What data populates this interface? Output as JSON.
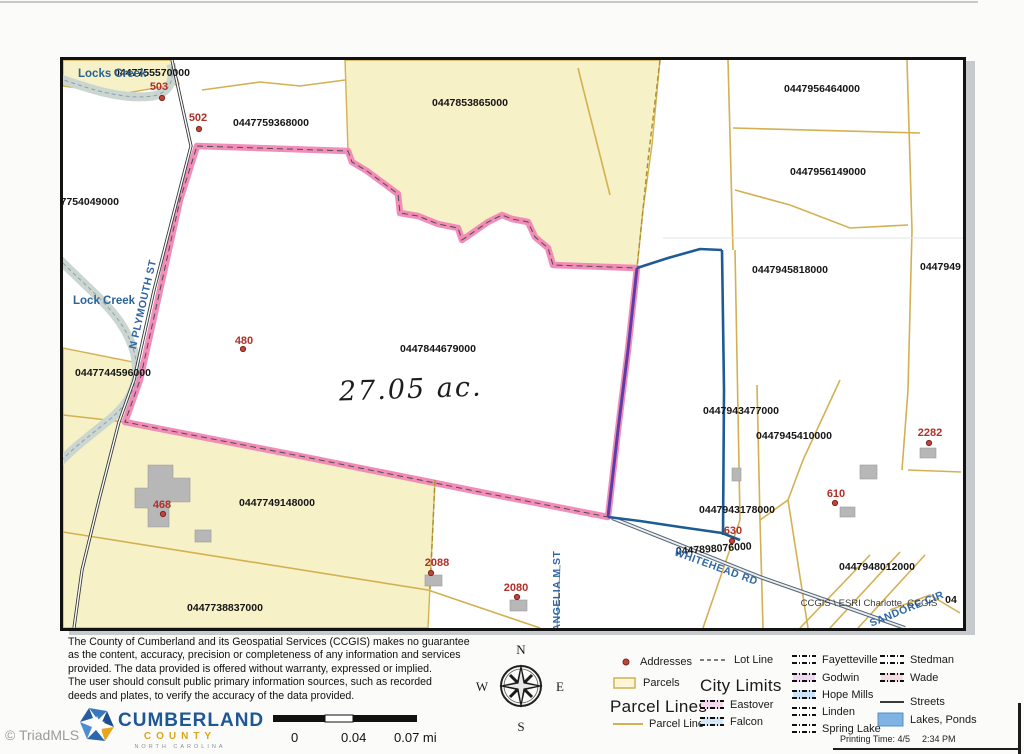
{
  "page": {
    "watermark": "© TriadMLS"
  },
  "print_footer": {
    "printing_time": "Printing Time: 4/5",
    "clock": "2:34 PM"
  },
  "disclaimer": {
    "lines": [
      "The County of Cumberland and its Geospatial Services (CCGIS) makes no guarantee",
      "as the content, accuracy, precision or completeness of any information and services",
      "provided. The data provided is offered without warranty, expressed or implied.",
      "The user should consult public primary information  sources, such as recorded",
      "deeds and plates, to verify the accuracy of the data provided."
    ]
  },
  "logo": {
    "name": "CUMBERLAND",
    "sub": "COUNTY",
    "state": "NORTH CAROLINA"
  },
  "scalebar": {
    "start": "0",
    "mid": "0.04",
    "end": "0.07 mi"
  },
  "compass": {
    "n": "N",
    "e": "E",
    "s": "S",
    "w": "W"
  },
  "legend": {
    "addresses_label": "Addresses",
    "parcels_label": "Parcels",
    "parcel_lines_header": "Parcel Lines",
    "parcel_line_label": "Parcel Line",
    "lot_line_label": "Lot Line",
    "city_limits_header": "City Limits",
    "streets_label": "Streets",
    "lakes_label": "Lakes, Ponds",
    "cities": [
      {
        "name": "Eastover",
        "tint": "#f3d9ea"
      },
      {
        "name": "Falcon",
        "tint": "#d6e8f7"
      },
      {
        "name": "Fayetteville",
        "tint": "#ffffff"
      },
      {
        "name": "Godwin",
        "tint": "#eed9ee"
      },
      {
        "name": "Hope Mills",
        "tint": "#cfe3f6"
      },
      {
        "name": "Linden",
        "tint": "#ffffff"
      },
      {
        "name": "Spring Lake",
        "tint": "#ffffff"
      },
      {
        "name": "Stedman",
        "tint": "#ffffff"
      },
      {
        "name": "Wade",
        "tint": "#f3dde3"
      }
    ]
  },
  "map": {
    "area_note": "27.05 ac.",
    "credit": "CCGIS \\ ESRI Charlotte, CCGIS",
    "edge_label": "04",
    "parcels": [
      {
        "id": "0447755570000"
      },
      {
        "id": "0447759368000"
      },
      {
        "id": "0447853865000"
      },
      {
        "id": "0447956464000"
      },
      {
        "id": "0447956149000"
      },
      {
        "id": "0447754049000"
      },
      {
        "id": "0447744596000"
      },
      {
        "id": "0447844679000"
      },
      {
        "id": "0447945818000"
      },
      {
        "id": "0447949"
      },
      {
        "id": "0447943477000"
      },
      {
        "id": "0447945410000"
      },
      {
        "id": "0447943178000"
      },
      {
        "id": "0447898076000"
      },
      {
        "id": "0447948012000"
      },
      {
        "id": "0447749148000"
      },
      {
        "id": "0447738837000"
      }
    ],
    "addresses": [
      {
        "label": "503"
      },
      {
        "label": "502"
      },
      {
        "label": "480"
      },
      {
        "label": "468"
      },
      {
        "label": "2088"
      },
      {
        "label": "2080"
      },
      {
        "label": "2282"
      },
      {
        "label": "610"
      },
      {
        "label": "630"
      }
    ],
    "streets": {
      "plymouth": "N PLYMOUTH ST",
      "whitehead": "WHITEHEAD RD",
      "angelia": "ANGELIA M ST",
      "sandore": "SANDORE CIR"
    },
    "creeks": {
      "top": "Locks Creek",
      "mid": "Lock Creek"
    }
  },
  "colors": {
    "highlight_pink": "#f287b7",
    "selection_blue": "#1d5b94",
    "selection_purple": "#5d3da6",
    "parcel_line_yellow": "#d3b052",
    "parcel_fill_yellow": "#f6f1c6",
    "address_red": "#b03028",
    "water_blue": "#7fb2e5"
  }
}
